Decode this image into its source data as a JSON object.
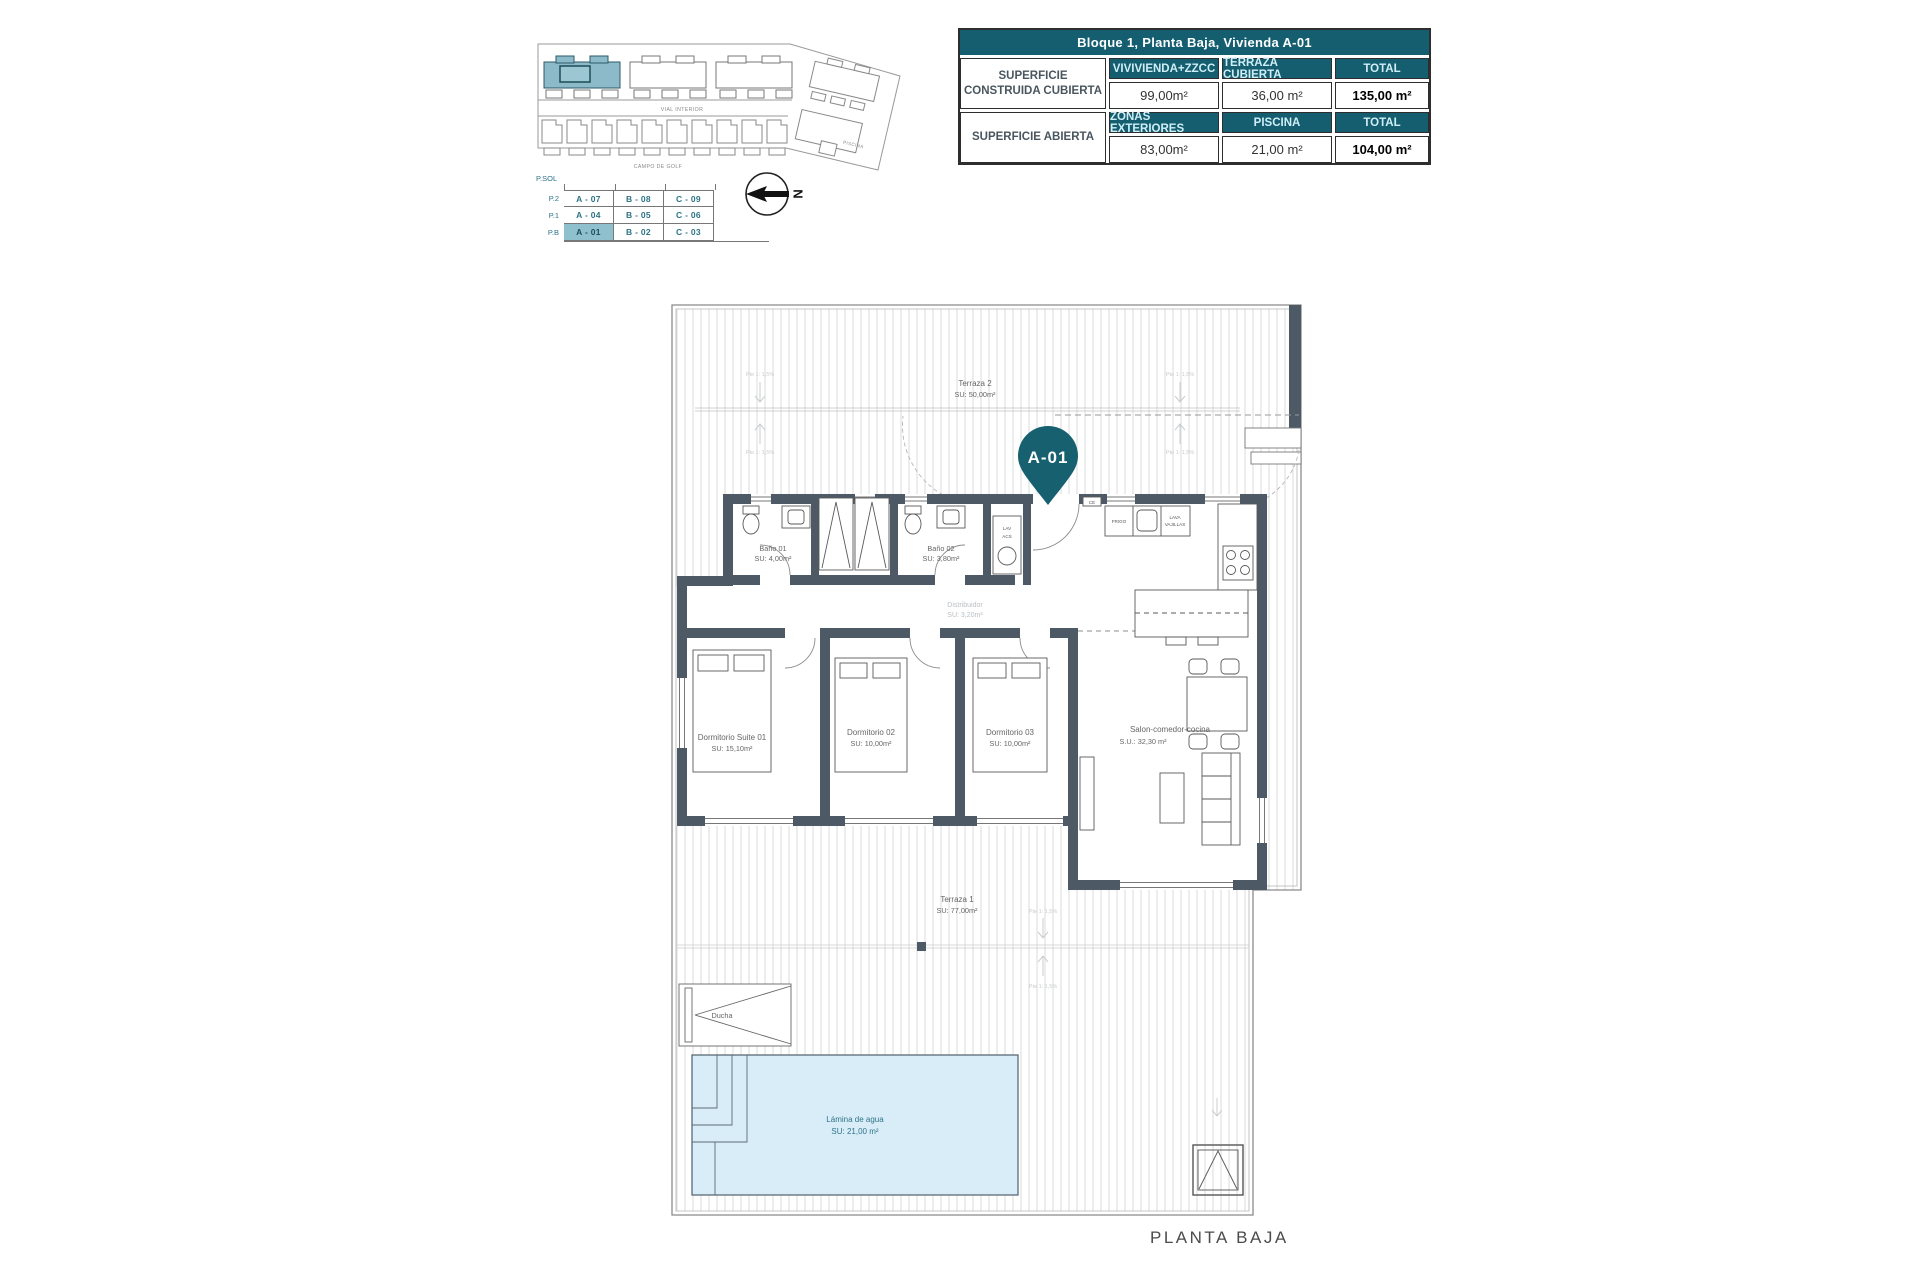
{
  "colors": {
    "accent_teal": "#145e70",
    "highlight_teal": "#8fc0cd",
    "wall": "#4d5a66",
    "pool_fill": "#d9edf8",
    "hatch_line": "#d2d2d2"
  },
  "site_plan": {
    "block_label": "BL1",
    "road_label": "VIAL INTERIOR",
    "golf_label": "CAMPO DE GOLF",
    "piscina_label": "PISCINA",
    "north_label": "N"
  },
  "levels": {
    "sol_label": "P.SOL",
    "rows": [
      {
        "level": "P.2",
        "units": [
          "A - 07",
          "B - 08",
          "C - 09"
        ]
      },
      {
        "level": "P.1",
        "units": [
          "A - 04",
          "B - 05",
          "C - 06"
        ]
      },
      {
        "level": "P.B",
        "units": [
          "A - 01",
          "B - 02",
          "C - 03"
        ]
      }
    ],
    "highlighted_unit": "A - 01"
  },
  "summary_table": {
    "title": "Bloque 1, Planta Baja, Vivienda A-01",
    "sections": [
      {
        "label": "SUPERFICIE CONSTRUIDA CUBIERTA",
        "columns": [
          "VIVIVIENDA+ZZCC",
          "TERRAZA CUBIERTA",
          "TOTAL"
        ],
        "values": [
          "99,00m²",
          "36,00 m²",
          "135,00 m²"
        ]
      },
      {
        "label": "SUPERFICIE ABIERTA",
        "columns": [
          "ZONAS EXTERIORES",
          "PISCINA",
          "TOTAL"
        ],
        "values": [
          "83,00m²",
          "21,00 m²",
          "104,00 m²"
        ]
      }
    ]
  },
  "floor_plan": {
    "unit_pin": "A-01",
    "plan_title": "PLANTA BAJA",
    "slope_note": "Pte 1: 1,5%",
    "rooms": {
      "terraza2": {
        "name": "Terraza 2",
        "area": "SU: 50,00m²"
      },
      "bano01": {
        "name": "Baño 01",
        "area": "SU: 4,00m²"
      },
      "bano02": {
        "name": "Baño 02",
        "area": "SU: 3,80m²"
      },
      "distribuidor": {
        "name": "Distribuidor",
        "area": "SU: 3,20m²"
      },
      "suite": {
        "name": "Dormitorio Suite 01",
        "area": "SU: 15,10m²"
      },
      "dorm02": {
        "name": "Dormitorio 02",
        "area": "SU: 10,00m²"
      },
      "dorm03": {
        "name": "Dormitorio 03",
        "area": "SU: 10,00m²"
      },
      "salon": {
        "name": "Salon-comedor-cocina",
        "area": "S.U.: 32,30 m²"
      },
      "terraza1": {
        "name": "Terraza 1",
        "area": "SU: 77,00m²"
      },
      "lamina": {
        "name": "Lámina de agua",
        "area": "SU: 21,00 m²"
      },
      "ducha": {
        "name": "Ducha"
      }
    },
    "fixtures": {
      "frigo": "FRIGO",
      "lava": "LAVA",
      "vajillas": "VAJILLAS",
      "lav": "LAV",
      "acs": "ACS",
      "ce": "CE"
    }
  }
}
